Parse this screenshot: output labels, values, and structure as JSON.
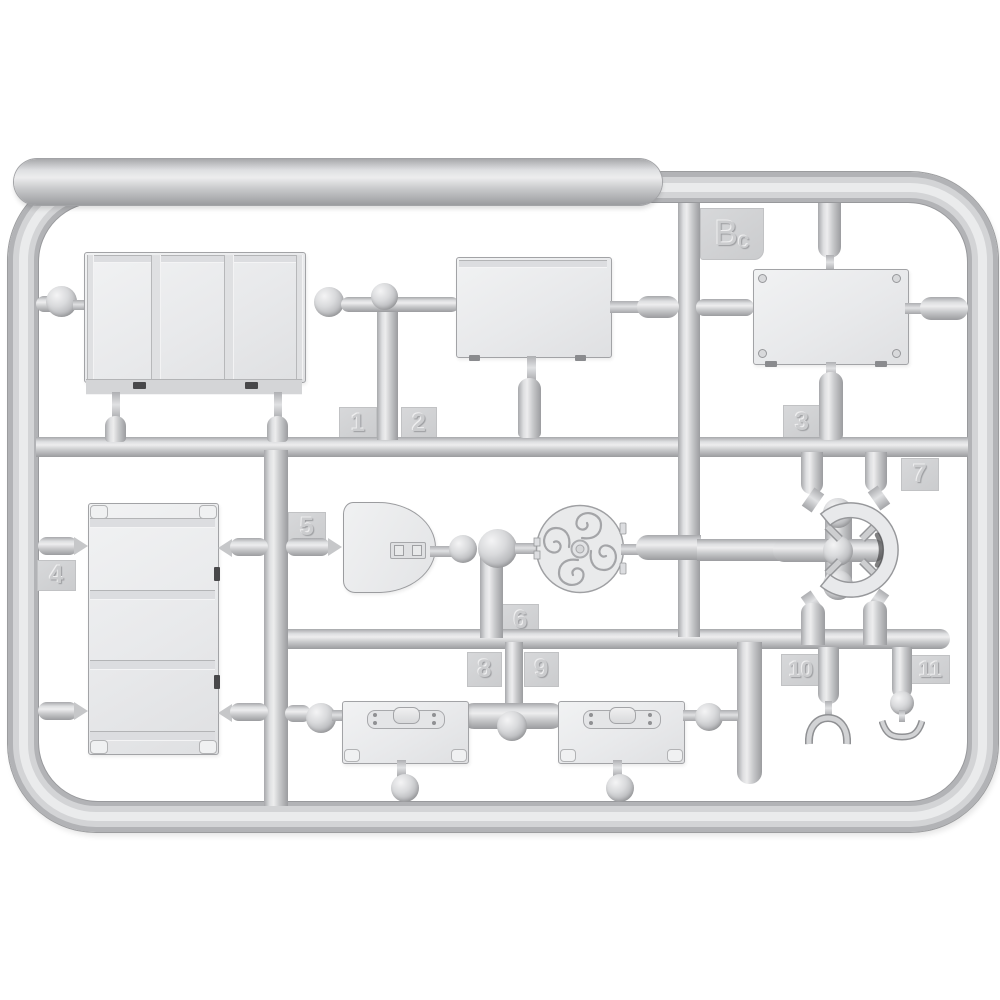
{
  "scene": {
    "description": "Light gray injection-molded plastic model-kit sprue (runner frame) photographed on white; parts attached to runners",
    "background_color": "#ffffff",
    "plastic_color": "#c9cacc",
    "part_fill_color": "#e9eaec",
    "label_pad_color": "#d0d1d3",
    "shadow_color": "#9b9c9f"
  },
  "sprue": {
    "id_label": "Bc",
    "id_letter_main": "B",
    "id_letter_sub": "c"
  },
  "part_labels": {
    "p1": "1",
    "p2": "2",
    "p3": "3",
    "p4": "4",
    "p5": "5",
    "p6": "6",
    "p7": "7",
    "p8": "8",
    "p9": "9",
    "p10": "10",
    "p11": "11"
  }
}
